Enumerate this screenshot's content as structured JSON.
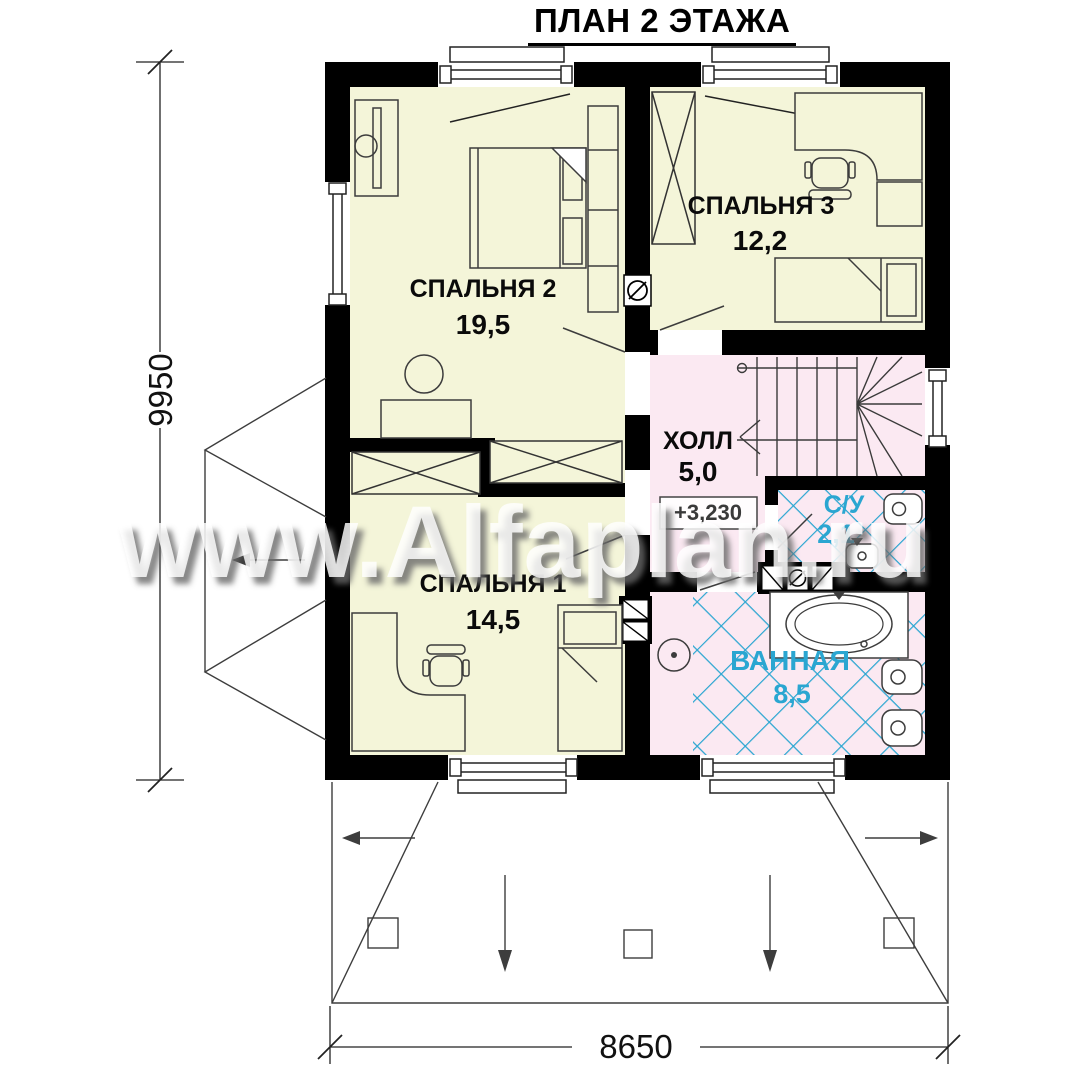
{
  "title": "ПЛАН 2 ЭТАЖА",
  "watermark": "www.Alfaplan.ru",
  "rooms": {
    "bedroom2": {
      "name": "СПАЛЬНЯ 2",
      "area": "19,5"
    },
    "bedroom3": {
      "name": "СПАЛЬНЯ 3",
      "area": "12,2"
    },
    "hall": {
      "name": "ХОЛЛ",
      "area": "5,0"
    },
    "wc": {
      "name": "С/У",
      "area": "2,1"
    },
    "bathroom": {
      "name": "ВАННАЯ",
      "area": "8,5"
    },
    "bedroom1": {
      "name": "СПАЛЬНЯ 1",
      "area": "14,5"
    }
  },
  "elevation_mark": "+3,230",
  "dimensions": {
    "vertical": "9950",
    "horizontal": "8650"
  },
  "colors": {
    "wall": "#000000",
    "bedroom_fill": "#F4F5D9",
    "wet_fill": "#FBE9F2",
    "tile_line": "#2AA6D1"
  }
}
